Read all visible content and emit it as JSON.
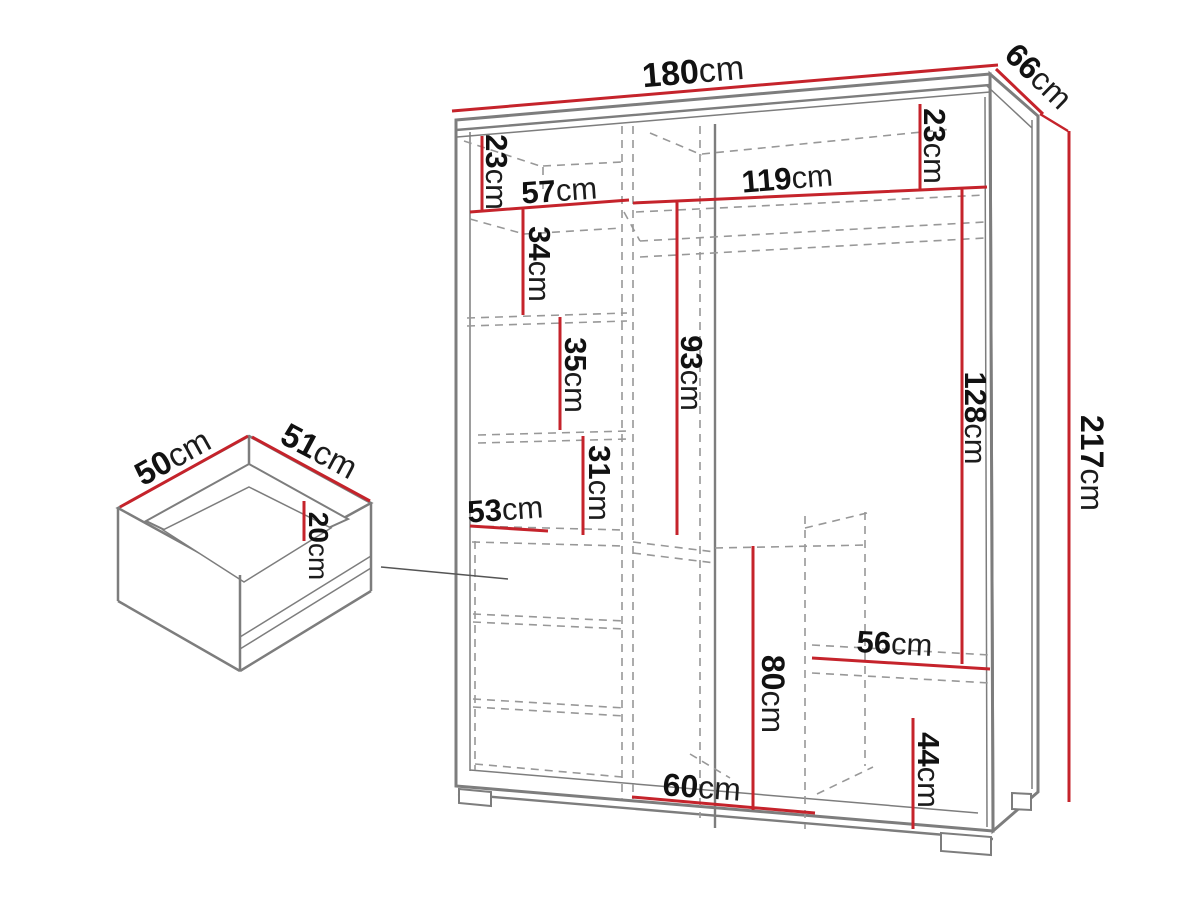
{
  "diagram": {
    "type": "furniture-dimension-diagram",
    "unit": "cm",
    "colors": {
      "dimension_line": "#c5232b",
      "structure_line": "#7d7d7d",
      "hidden_line": "#989898",
      "callout_line": "#555555",
      "label_text": "#111111",
      "background": "#ffffff"
    }
  },
  "wardrobe": {
    "dims": {
      "width": {
        "value": "180",
        "unit": "cm"
      },
      "depth": {
        "value": "66",
        "unit": "cm"
      },
      "height": {
        "value": "217",
        "unit": "cm"
      },
      "top_shelf_left": {
        "value": "23",
        "unit": "cm"
      },
      "left_section_width": {
        "value": "57",
        "unit": "cm"
      },
      "right_section_width": {
        "value": "119",
        "unit": "cm"
      },
      "top_shelf_right": {
        "value": "23",
        "unit": "cm"
      },
      "left_gap_1": {
        "value": "34",
        "unit": "cm"
      },
      "left_gap_2": {
        "value": "35",
        "unit": "cm"
      },
      "left_gap_3": {
        "value": "31",
        "unit": "cm"
      },
      "middle_height": {
        "value": "93",
        "unit": "cm"
      },
      "right_opening_height": {
        "value": "128",
        "unit": "cm"
      },
      "drawer_section_width": {
        "value": "53",
        "unit": "cm"
      },
      "right_shelf_width": {
        "value": "56",
        "unit": "cm"
      },
      "lower_middle_height": {
        "value": "80",
        "unit": "cm"
      },
      "lower_right_height": {
        "value": "44",
        "unit": "cm"
      },
      "bottom_opening_width": {
        "value": "60",
        "unit": "cm"
      }
    }
  },
  "drawer": {
    "dims": {
      "width": {
        "value": "50",
        "unit": "cm"
      },
      "depth": {
        "value": "51",
        "unit": "cm"
      },
      "height": {
        "value": "20",
        "unit": "cm"
      }
    }
  }
}
